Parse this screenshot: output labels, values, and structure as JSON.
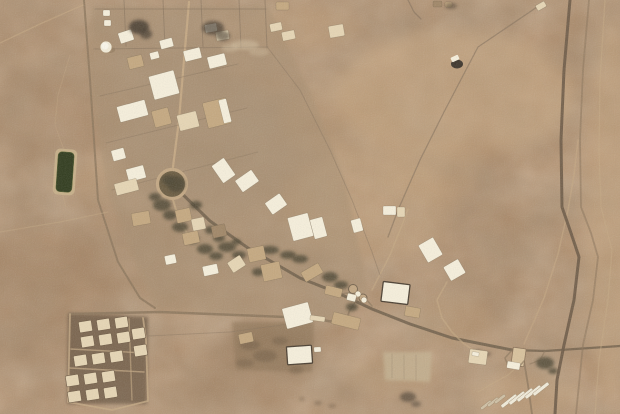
{
  "palette": {
    "desert_base": "#b08b68",
    "white": "#f7f0dc",
    "cream": "#e7d6b4",
    "tan": "#c5a87f",
    "dark_tan": "#a08666",
    "road_dark": "#6f5e49",
    "road_mid": "#8d775c",
    "track_light": "#c6aa84",
    "fence": "#84705a",
    "trees": "#4c4431",
    "pond": "#2f3a1c",
    "pond_border": "#c9b18a",
    "burn": "#453a2f",
    "highway": "#6b5945",
    "strip_white": "#f2ecda",
    "strip_gray": "#cfc0a4",
    "campus_ground": "#a78e6f",
    "housing_ground": "#6e5a44",
    "pad_light": "#c5b291",
    "south_pad": "#8a7153",
    "bridge": "#d9c29c",
    "ring": "#c4a883",
    "ring_inner": "#6b5c41",
    "veh_dark": "#352e26",
    "frame": "#4a3e30",
    "bldg_edge": "#5a4c3a"
  },
  "terrain": {
    "width": 620,
    "height": 414,
    "patches": [
      [
        455,
        95,
        120,
        65,
        "#c7a67f",
        0.5
      ],
      [
        370,
        205,
        85,
        55,
        "#c7a67f",
        0.4
      ],
      [
        300,
        28,
        55,
        22,
        "#bd9c76",
        0.35
      ],
      [
        55,
        115,
        70,
        45,
        "#9c7c5c",
        0.3
      ],
      [
        35,
        305,
        85,
        65,
        "#9c7c5c",
        0.35
      ],
      [
        45,
        255,
        60,
        35,
        "#9c7c5c",
        0.25
      ],
      [
        480,
        235,
        45,
        100,
        "#9c7c5c",
        0.25
      ],
      [
        610,
        210,
        25,
        190,
        "#c7a67f",
        0.45
      ],
      [
        525,
        395,
        55,
        22,
        "#c7a67f",
        0.35
      ],
      [
        262,
        352,
        55,
        26,
        "#8f7254",
        0.45
      ],
      [
        205,
        148,
        85,
        75,
        "#a79177",
        0.45
      ],
      [
        165,
        62,
        65,
        45,
        "#a79177",
        0.4
      ],
      [
        120,
        250,
        60,
        40,
        "#9c7c5c",
        0.25
      ],
      [
        340,
        120,
        60,
        40,
        "#bd9c76",
        0.3
      ],
      [
        430,
        170,
        50,
        30,
        "#c7a67f",
        0.3
      ],
      [
        570,
        40,
        30,
        35,
        "#9c7c5c",
        0.2
      ],
      [
        30,
        30,
        40,
        25,
        "#9c7c5c",
        0.25
      ],
      [
        230,
        390,
        60,
        20,
        "#9c7c5c",
        0.3
      ],
      [
        390,
        375,
        45,
        18,
        "#bd9c76",
        0.35
      ],
      [
        100,
        180,
        30,
        20,
        "#bd9c76",
        0.3
      ],
      [
        450,
        320,
        40,
        25,
        "#bd9c76",
        0.3
      ]
    ]
  },
  "ground_zones": [
    {
      "name": "campus-ground",
      "points": "93,6 268,6 312,95 345,180 368,290 345,322 155,310 108,195 86,60",
      "fill": "campus_ground",
      "opacity": 0.5
    },
    {
      "name": "housing-ground",
      "points": "68,313 148,317 147,404 67,404",
      "fill": "housing_ground",
      "opacity": 0.8
    },
    {
      "name": "south-pad",
      "points": "232,322 314,322 312,372 236,370",
      "fill": "south_pad",
      "opacity": 0.55
    },
    {
      "name": "east-pad",
      "points": "383,352 432,352 430,382 385,380",
      "fill": "pad_light",
      "opacity": 0.8
    }
  ],
  "roads": [
    {
      "name": "west-perimeter-road",
      "pts": "84,0 90,80 98,200 118,262 140,298 155,308",
      "w": 2,
      "c": "road_mid",
      "o": 0.85
    },
    {
      "name": "housing-road",
      "pts": "70,314 160,312 310,318 346,324",
      "w": 2.5,
      "c": "road_mid",
      "o": 0.9
    },
    {
      "name": "main-diagonal-road",
      "pts": "172,184 210,221 248,248 300,278 338,293",
      "w": 3,
      "c": "road_dark",
      "o": 0.85
    },
    {
      "name": "east-road",
      "pts": "338,293 372,309 410,324 452,338 512,350",
      "w": 3,
      "c": "road_dark",
      "o": 0.85
    },
    {
      "name": "gate-connector",
      "pts": "357,299 349,312 346,323",
      "w": 1.8,
      "c": "road_mid",
      "o": 0.8
    },
    {
      "name": "gate-link",
      "pts": "340,294 355,292 366,299 372,306",
      "w": 1.5,
      "c": "road_mid",
      "o": 0.7
    },
    {
      "name": "campus-ns-road",
      "pts": "189,2 184,60 179,120 173,167",
      "w": 2.2,
      "c": "track_light",
      "o": 0.9
    },
    {
      "name": "roundabout-south-road",
      "pts": "173,200 177,213 182,226 190,237",
      "w": 2,
      "c": "track_light",
      "o": 0.8
    },
    {
      "name": "ne-track",
      "pts": "372,290 390,255 402,225 408,209",
      "w": 1.5,
      "c": "track_light",
      "o": 0.6
    },
    {
      "name": "east-exit-road",
      "pts": "512,350 545,351 620,346",
      "w": 2.2,
      "c": "road_dark",
      "o": 0.8
    },
    {
      "name": "south-exit-road",
      "pts": "524,361 528,385 532,414",
      "w": 1.8,
      "c": "road_mid",
      "o": 0.8
    },
    {
      "name": "north-service-road",
      "pts": "524,344 544,298 558,254 568,210 574,175 578,140",
      "w": 1.5,
      "c": "track_light",
      "o": 0.55
    },
    {
      "name": "highway",
      "pts": "570,0 564,70 561,140 562,207 571,233 579,257 574,300 564,345 557,380 555,414",
      "w": 3,
      "c": "highway",
      "o": 0.9
    },
    {
      "name": "highway-parallel",
      "pts": "589,0 583,70 580,140 581,207 591,233 598,257 593,300 583,345 576,414",
      "w": 1.8,
      "c": "road_mid",
      "o": 0.6
    },
    {
      "name": "far-right-track",
      "pts": "605,0 600,80 599,150 601,207 612,250 608,300 599,360 595,414",
      "w": 1.3,
      "c": "track_light",
      "o": 0.5
    },
    {
      "name": "ne-fence",
      "pts": "540,5 478,47 444,112 420,160 398,210 388,237",
      "w": 1.3,
      "c": "fence",
      "o": 0.6
    },
    {
      "name": "top-stub",
      "pts": "408,0 414,12 421,19",
      "w": 1.3,
      "c": "fence",
      "o": 0.6
    },
    {
      "name": "nw-track",
      "pts": "0,43 40,24 83,5",
      "w": 1.4,
      "c": "track_light",
      "o": 0.55
    },
    {
      "name": "west-track",
      "pts": "0,232 60,222 108,212",
      "w": 1.2,
      "c": "track_light",
      "o": 0.4
    },
    {
      "name": "wavy-track",
      "pts": "70,55 58,95 55,125 64,150 60,185 66,207",
      "w": 1,
      "c": "track_light",
      "o": 0.35
    },
    {
      "name": "fence-top",
      "pts": "95,9 266,9",
      "w": 1,
      "c": "fence",
      "o": 0.55
    },
    {
      "name": "fence-v1",
      "pts": "124,0 126,46",
      "w": 1,
      "c": "fence",
      "o": 0.55
    },
    {
      "name": "fence-v2",
      "pts": "163,0 165,47",
      "w": 1,
      "c": "fence",
      "o": 0.55
    },
    {
      "name": "fence-v3",
      "pts": "201,0 203,47",
      "w": 1,
      "c": "fence",
      "o": 0.55
    },
    {
      "name": "fence-v4",
      "pts": "239,0 241,48",
      "w": 1,
      "c": "fence",
      "o": 0.55
    },
    {
      "name": "fence-v5",
      "pts": "265,0 267,48",
      "w": 1,
      "c": "fence",
      "o": 0.55
    },
    {
      "name": "fence-row2",
      "pts": "94,49 268,47",
      "w": 1,
      "c": "fence",
      "o": 0.5
    },
    {
      "name": "east-fence",
      "pts": "268,48 300,90 330,150 352,200 372,252 380,275",
      "w": 1,
      "c": "fence",
      "o": 0.45
    },
    {
      "name": "lot-line-1",
      "pts": "100,96 238,64",
      "w": 1,
      "c": "fence",
      "o": 0.4
    },
    {
      "name": "lot-line-2",
      "pts": "106,143 247,108",
      "w": 1,
      "c": "fence",
      "o": 0.4
    },
    {
      "name": "lot-line-3",
      "pts": "112,190 258,152",
      "w": 1,
      "c": "fence",
      "o": 0.35
    },
    {
      "name": "compound-perimeter",
      "pts": "70,314 69,360 68,402 112,410 148,401 146,340 143,318",
      "w": 1.8,
      "c": "track_light",
      "o": 0.8
    },
    {
      "name": "compound-street-1",
      "pts": "71,349 145,353",
      "w": 1.4,
      "c": "track_light",
      "o": 0.7
    },
    {
      "name": "compound-street-2",
      "pts": "70,368 144,372",
      "w": 1.4,
      "c": "track_light",
      "o": 0.7
    },
    {
      "name": "compound-street-3",
      "pts": "129,319 132,400",
      "w": 1.4,
      "c": "track_light",
      "o": 0.6
    },
    {
      "name": "housing-south-track",
      "pts": "148,336 230,332 312,321",
      "w": 1,
      "c": "fence",
      "o": 0.4
    },
    {
      "name": "curve-track-se",
      "pts": "447,282 437,300 442,318 452,332 463,343 473,350",
      "w": 1.6,
      "c": "track_light",
      "o": 0.6
    },
    {
      "name": "strip-access",
      "pts": "524,361 508,375 490,385 478,392",
      "w": 1.3,
      "c": "track_light",
      "o": 0.5
    },
    {
      "name": "pad-line-1",
      "pts": "392,354 392,378",
      "w": 1,
      "c": "fence",
      "o": 0.25
    },
    {
      "name": "pad-line-2",
      "pts": "404,355 404,379",
      "w": 1,
      "c": "fence",
      "o": 0.25
    },
    {
      "name": "pad-line-3",
      "pts": "416,355 416,380",
      "w": 1,
      "c": "fence",
      "o": 0.25
    }
  ],
  "buildings": [
    [
      119,
      31,
      14,
      11,
      -18,
      "white"
    ],
    [
      160,
      39,
      13,
      9,
      -15,
      "white"
    ],
    [
      184,
      49,
      17,
      11,
      -14,
      "white"
    ],
    [
      150,
      52,
      9,
      7,
      -15,
      "white"
    ],
    [
      128,
      56,
      15,
      12,
      -14,
      "tan"
    ],
    [
      208,
      55,
      18,
      12,
      -14,
      "white"
    ],
    [
      151,
      73,
      26,
      24,
      -15,
      "white"
    ],
    [
      118,
      103,
      29,
      16,
      -15,
      "white"
    ],
    [
      153,
      109,
      17,
      17,
      -15,
      "tan"
    ],
    [
      178,
      113,
      20,
      16,
      -14,
      "cream"
    ],
    [
      205,
      100,
      24,
      26,
      -14,
      "tan"
    ],
    [
      221,
      99,
      8,
      24,
      -14,
      "white"
    ],
    [
      112,
      149,
      13,
      11,
      -15,
      "white"
    ],
    [
      127,
      167,
      18,
      13,
      -15,
      "white"
    ],
    [
      115,
      181,
      23,
      12,
      -15,
      "cream"
    ],
    [
      216,
      160,
      15,
      21,
      -35,
      "white"
    ],
    [
      237,
      174,
      20,
      14,
      -35,
      "white"
    ],
    [
      267,
      197,
      18,
      14,
      -35,
      "white"
    ],
    [
      290,
      215,
      21,
      24,
      -15,
      "white"
    ],
    [
      312,
      218,
      13,
      20,
      -15,
      "white"
    ],
    [
      352,
      219,
      10,
      13,
      -15,
      "white"
    ],
    [
      383,
      206,
      13,
      9,
      0,
      "white"
    ],
    [
      397,
      207,
      8,
      10,
      0,
      "cream"
    ],
    [
      103,
      10,
      7,
      6,
      0,
      "white"
    ],
    [
      104,
      20,
      7,
      6,
      0,
      "white"
    ],
    [
      205,
      24,
      12,
      8,
      -10,
      "white"
    ],
    [
      216,
      31,
      13,
      9,
      -10,
      "cream"
    ],
    [
      270,
      23,
      12,
      8,
      -12,
      "cream"
    ],
    [
      282,
      31,
      13,
      9,
      -12,
      "cream"
    ],
    [
      276,
      2,
      13,
      8,
      0,
      "tan"
    ],
    [
      329,
      25,
      15,
      12,
      -10,
      "cream"
    ],
    [
      433,
      1,
      9,
      6,
      0,
      "dark_tan"
    ],
    [
      445,
      2,
      7,
      5,
      0,
      "tan"
    ],
    [
      536,
      3,
      10,
      6,
      -30,
      "cream"
    ],
    [
      132,
      212,
      18,
      13,
      -10,
      "tan"
    ],
    [
      176,
      209,
      15,
      13,
      -12,
      "tan"
    ],
    [
      192,
      218,
      13,
      12,
      -12,
      "cream"
    ],
    [
      183,
      232,
      16,
      12,
      -12,
      "tan"
    ],
    [
      212,
      225,
      14,
      12,
      -12,
      "dark_tan"
    ],
    [
      229,
      258,
      15,
      12,
      -33,
      "cream"
    ],
    [
      262,
      263,
      19,
      17,
      -12,
      "tan"
    ],
    [
      302,
      267,
      20,
      11,
      -30,
      "tan"
    ],
    [
      203,
      265,
      15,
      10,
      -12,
      "white"
    ],
    [
      165,
      255,
      11,
      9,
      -12,
      "white"
    ],
    [
      248,
      247,
      17,
      14,
      -12,
      "tan"
    ],
    [
      284,
      305,
      27,
      21,
      -15,
      "white"
    ],
    [
      332,
      315,
      28,
      12,
      14,
      "tan"
    ],
    [
      325,
      287,
      17,
      9,
      14,
      "tan"
    ],
    [
      347,
      294,
      9,
      7,
      14,
      "white"
    ],
    [
      382,
      283,
      27,
      20,
      7,
      "white",
      "frame"
    ],
    [
      405,
      307,
      15,
      10,
      10,
      "tan"
    ],
    [
      422,
      240,
      17,
      20,
      -30,
      "white"
    ],
    [
      446,
      262,
      17,
      16,
      -30,
      "white"
    ],
    [
      239,
      333,
      14,
      10,
      -12,
      "tan"
    ],
    [
      287,
      346,
      25,
      18,
      -4,
      "white",
      "frame"
    ],
    [
      314,
      347,
      7,
      5,
      -4,
      "white"
    ],
    [
      310,
      316,
      15,
      5,
      8,
      "cream"
    ],
    [
      469,
      350,
      18,
      14,
      8,
      "cream"
    ],
    [
      472,
      352,
      7,
      4,
      8,
      "white"
    ],
    [
      507,
      362,
      13,
      7,
      10,
      "white"
    ]
  ],
  "housing": {
    "unit_w": 13,
    "unit_h": 11,
    "rot": -9,
    "fill": "cream",
    "units": [
      [
        79,
        321
      ],
      [
        97,
        319
      ],
      [
        115,
        317
      ],
      [
        81,
        336
      ],
      [
        99,
        334
      ],
      [
        117,
        332
      ],
      [
        74,
        355
      ],
      [
        92,
        353
      ],
      [
        110,
        351
      ],
      [
        132,
        328
      ],
      [
        134,
        345
      ],
      [
        66,
        375
      ],
      [
        84,
        373
      ],
      [
        102,
        371
      ],
      [
        68,
        391
      ],
      [
        86,
        389
      ],
      [
        104,
        387
      ]
    ]
  },
  "trees": [
    [
      162,
      205,
      9,
      6
    ],
    [
      170,
      215,
      7,
      5
    ],
    [
      155,
      197,
      6,
      4
    ],
    [
      180,
      227,
      8,
      5
    ],
    [
      192,
      239,
      7,
      5
    ],
    [
      205,
      249,
      8,
      5
    ],
    [
      216,
      256,
      7,
      4
    ],
    [
      227,
      247,
      9,
      5
    ],
    [
      239,
      255,
      7,
      4
    ],
    [
      258,
      272,
      6,
      4
    ],
    [
      270,
      250,
      9,
      4
    ],
    [
      288,
      255,
      8,
      4
    ],
    [
      300,
      259,
      8,
      4
    ],
    [
      330,
      277,
      8,
      5
    ],
    [
      341,
      285,
      7,
      4
    ],
    [
      352,
      307,
      6,
      4
    ],
    [
      219,
      238,
      6,
      4
    ],
    [
      196,
      205,
      6,
      4
    ],
    [
      236,
      242,
      5,
      3
    ],
    [
      210,
      230,
      5,
      4
    ],
    [
      545,
      363,
      9,
      6
    ],
    [
      553,
      371,
      5,
      3
    ],
    [
      176,
      184,
      9,
      8
    ],
    [
      168,
      180,
      6,
      5
    ]
  ],
  "smudges": [
    [
      250,
      345,
      10,
      5,
      "#6e5a43",
      0.5
    ],
    [
      265,
      356,
      12,
      6,
      "#6e5a43",
      0.5
    ],
    [
      280,
      341,
      8,
      4,
      "#6e5a43",
      0.45
    ],
    [
      245,
      363,
      9,
      4,
      "#6e5a43",
      0.4
    ],
    [
      296,
      370,
      7,
      4,
      "#6e5a43",
      0.4
    ],
    [
      318,
      403,
      4,
      2,
      "#6b5741",
      0.5
    ],
    [
      332,
      406,
      4,
      2,
      "#6b5741",
      0.45
    ],
    [
      302,
      399,
      3,
      2,
      "#6b5741",
      0.4
    ],
    [
      245,
      45,
      14,
      5,
      "#d6c3a3",
      0.5
    ],
    [
      259,
      52,
      10,
      4,
      "#d6c3a3",
      0.35
    ],
    [
      230,
      48,
      8,
      4,
      "#d6c3a3",
      0.4
    ],
    [
      478,
      352,
      5,
      2,
      "#453a2f",
      0.5
    ],
    [
      487,
      354,
      4,
      2,
      "#453a2f",
      0.45
    ]
  ],
  "burns": [
    [
      139,
      27,
      10,
      7,
      0.85
    ],
    [
      146,
      34,
      6,
      5,
      0.7
    ],
    [
      213,
      28,
      11,
      7,
      0.7
    ],
    [
      223,
      36,
      7,
      5,
      0.6
    ],
    [
      451,
      6,
      6,
      3,
      0.5
    ],
    [
      408,
      397,
      8,
      5,
      0.6
    ],
    [
      416,
      404,
      5,
      3,
      0.5
    ]
  ],
  "strips": [
    [
      486,
      405,
      13,
      3,
      -38,
      "strip_gray"
    ],
    [
      493,
      402,
      13,
      3,
      -38,
      "strip_gray"
    ],
    [
      500,
      399,
      13,
      3,
      -38,
      "strip_gray"
    ],
    [
      509,
      401,
      19,
      3.5,
      -38,
      "strip_white"
    ],
    [
      517,
      398,
      19,
      3.5,
      -38,
      "strip_white"
    ],
    [
      525,
      395,
      19,
      3.5,
      -38,
      "strip_white"
    ],
    [
      533,
      392,
      19,
      3.5,
      -38,
      "strip_white"
    ],
    [
      541,
      389,
      19,
      3.5,
      -38,
      "strip_white"
    ]
  ],
  "pond": {
    "x": 57,
    "y": 152,
    "w": 16,
    "h": 40,
    "rot": 4
  },
  "tank": {
    "cx": 106,
    "cy": 47,
    "r": 6
  },
  "roundabout": {
    "cx": 172,
    "cy": 184,
    "r": 14.5
  },
  "gate_circles": [
    [
      353,
      289,
      4.5
    ],
    [
      363,
      298,
      4
    ]
  ],
  "small_tanks": [
    [
      358,
      294,
      3
    ],
    [
      364,
      300,
      3
    ]
  ],
  "interchange": {
    "bridge": {
      "x": 512,
      "y": 348,
      "w": 13,
      "h": 18,
      "rot": 8
    },
    "ramps": [
      {
        "pts": "512,350 505,358 508,366 518,368 524,361",
        "w": 1.5,
        "c": "road_mid",
        "o": 0.7
      },
      {
        "pts": "545,351 540,360 530,364",
        "w": 1.3,
        "c": "road_mid",
        "o": 0.6
      }
    ]
  },
  "vehicle": {
    "cx": 457,
    "cy": 64,
    "rx": 6,
    "ry": 4.5,
    "cab": [
      451,
      56,
      8,
      5,
      -25
    ]
  }
}
